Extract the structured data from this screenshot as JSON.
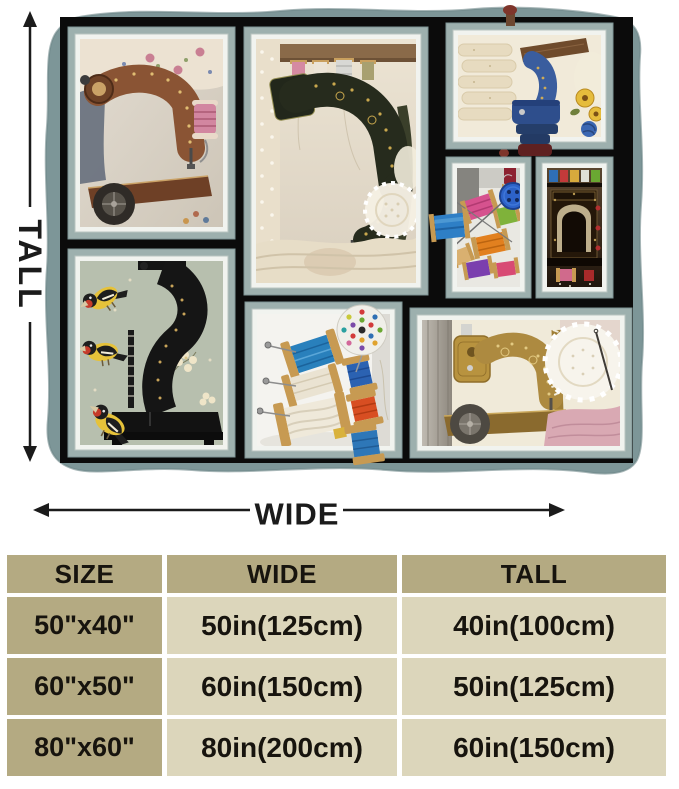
{
  "figure": {
    "tall_label": "TALL",
    "wide_label": "WIDE",
    "panel_names": [
      "bronze-antique-sewing-machine-with-floral-fabric",
      "black-sewing-machine-with-goldfinch-birds",
      "dark-green-antique-sewing-machine-with-lace-and-spools",
      "blue-sewing-machine-with-yellow-flowers",
      "colorful-thread-spools-with-blue-button",
      "ornate-sewing-machine-in-dark-wooden-nook",
      "thread-spools-with-polka-dot-pincushion",
      "golden-sewing-machine-with-lace-doily"
    ]
  },
  "size_table": {
    "headers": {
      "size": "SIZE",
      "wide": "WIDE",
      "tall": "TALL"
    },
    "rows": [
      {
        "size": "50\"x40\"",
        "wide": "50in(125cm)",
        "tall": "40in(100cm)"
      },
      {
        "size": "60\"x50\"",
        "wide": "60in(150cm)",
        "tall": "50in(125cm)"
      },
      {
        "size": "80\"x60\"",
        "wide": "80in(200cm)",
        "tall": "60in(150cm)"
      }
    ]
  },
  "colors": {
    "blanket_teal": "#7d9698",
    "panel_frame_teal": "#9db0ae",
    "frame_black": "#0b0b0b",
    "table_header_bg": "#b4aa82",
    "table_cell_bg": "#dcd6bb",
    "label_text": "#1b1b1b"
  }
}
